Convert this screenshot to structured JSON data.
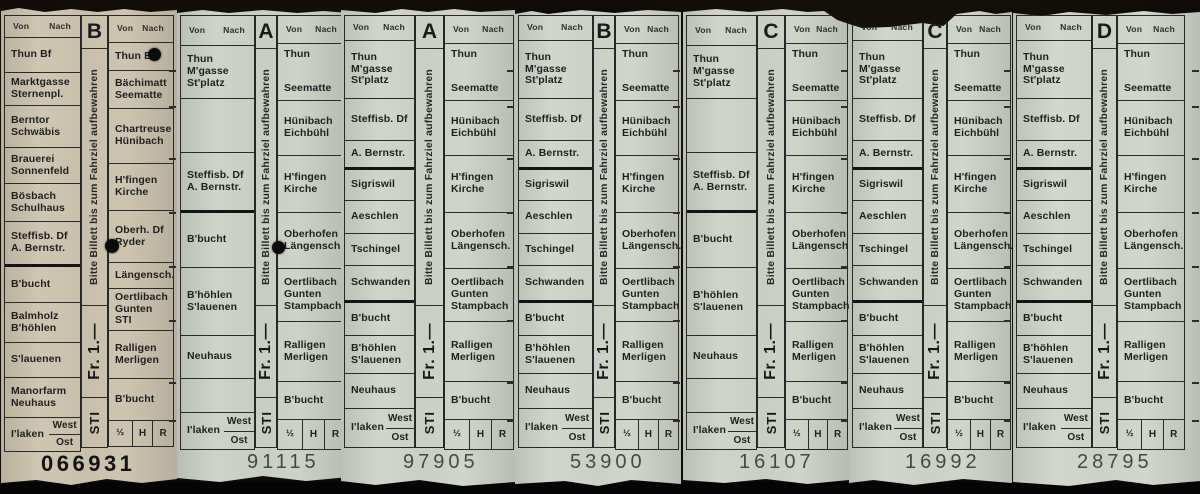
{
  "photo": {
    "background_color": "#0d0a07",
    "description_colors": {
      "beige_ticket": "#cbc3ae",
      "green_ticket": "#ced3c8",
      "print": "#1f1f1f"
    }
  },
  "shared": {
    "keep_notice": "Bitte Billett bis zum Fahrziel aufbewahren",
    "price": "Fr. 1.—",
    "operator": "STI",
    "header": {
      "von": "Von",
      "nach": "Nach"
    },
    "fare_cells": [
      "½",
      "H",
      "R"
    ],
    "ilaken": {
      "name": "I'laken",
      "top": "West",
      "bottom": "Ost"
    }
  },
  "columns": {
    "t1_left": [
      {
        "type": "header",
        "h": 22
      },
      {
        "label": "Thun Bf",
        "h": 35
      },
      {
        "label": "Marktgasse\nSternenpl.",
        "h": 33
      },
      {
        "label": "Berntor\nSchwäbis",
        "h": 42
      },
      {
        "label": "Brauerei\nSonnenfeld",
        "h": 36
      },
      {
        "label": "Bösbach\nSchulhaus",
        "h": 38
      },
      {
        "label": "Steffisb. Df\nA. Bernstr.",
        "h": 45,
        "thick": true
      },
      {
        "label": "B'bucht",
        "h": 36
      },
      {
        "label": "Balmholz\nB'höhlen",
        "h": 40
      },
      {
        "label": "S'lauenen",
        "h": 35
      },
      {
        "label": "Manorfarm\nNeuhaus",
        "h": 40
      },
      {
        "type": "ilaken",
        "h": 33
      }
    ],
    "t1_right": [
      {
        "type": "header",
        "h": 27
      },
      {
        "label": "Thun Bf",
        "h": 28
      },
      {
        "label": "Bächimatt\nSeematte",
        "h": 38
      },
      {
        "label": "Chartreuse\nHünibach",
        "h": 55
      },
      {
        "label": "H'fingen\nKirche",
        "h": 47
      },
      {
        "label": "Oberh. Df\nRyder",
        "h": 52
      },
      {
        "label": "Längensch.",
        "h": 26
      },
      {
        "label": "Oertlibach\nGunten STI",
        "h": 42
      },
      {
        "label": "Ralligen\nMerligen",
        "h": 48
      },
      {
        "label": "B'bucht",
        "h": 42
      },
      {
        "type": "fare",
        "h": 25
      }
    ],
    "x_left": [
      {
        "type": "header",
        "h": 30
      },
      {
        "label": "Thun\nM'gasse\nSt'platz",
        "h": 53
      },
      {
        "type": "empty",
        "h": 54
      },
      {
        "label": "Steffisb. Df\nA. Bernstr.",
        "h": 60,
        "thick": true
      },
      {
        "label": "B'bucht",
        "h": 55
      },
      {
        "label": "B'höhlen\nS'lauenen",
        "h": 68
      },
      {
        "label": "Neuhaus",
        "h": 43
      },
      {
        "type": "empty",
        "h": 34
      },
      {
        "type": "ilaken",
        "h": 36
      }
    ],
    "y_left": [
      {
        "type": "header",
        "h": 25
      },
      {
        "label": "Thun\nM'gasse\nSt'platz",
        "h": 58
      },
      {
        "label": "Steffisb. Df",
        "h": 42
      },
      {
        "label": "A. Bernstr.",
        "h": 29,
        "thick": true
      },
      {
        "label": "Sigriswil",
        "h": 31
      },
      {
        "label": "Aeschlen",
        "h": 33
      },
      {
        "label": "Tschingel",
        "h": 32
      },
      {
        "label": "Schwanden",
        "h": 37,
        "thick": true
      },
      {
        "label": "B'bucht",
        "h": 33
      },
      {
        "label": "B'höhlen\nS'lauenen",
        "h": 38
      },
      {
        "label": "Neuhaus",
        "h": 35
      },
      {
        "type": "ilaken",
        "h": 38
      }
    ],
    "std_right": [
      {
        "type": "header",
        "h": 28
      },
      {
        "type": "split",
        "top": "Thun",
        "bottom": "Seematte",
        "h": 57
      },
      {
        "label": "Hünibach\nEichbühl",
        "h": 55
      },
      {
        "label": "H'fingen\nKirche",
        "h": 57
      },
      {
        "label": "Oberhofen\nLängensch.",
        "h": 56
      },
      {
        "label": "Oertlibach\nGunten\nStampbach",
        "h": 53
      },
      {
        "label": "Ralligen\nMerligen",
        "h": 60
      },
      {
        "label": "B'bucht",
        "h": 38
      },
      {
        "type": "fare",
        "h": 29
      }
    ]
  },
  "tickets": [
    {
      "letter": "B",
      "serial": "066931",
      "serial_style": "dark",
      "paper": "#cbc3ae",
      "x": 1,
      "width": 176,
      "lw": 77,
      "sw": 27,
      "rw": 66,
      "serial_left": 40,
      "left": "t1_left",
      "right": "t1_right",
      "punches": [
        {
          "x": 153,
          "y": 54,
          "d": 13
        },
        {
          "x": 111,
          "y": 246,
          "d": 14
        }
      ]
    },
    {
      "letter": "A",
      "serial": "91115",
      "serial_style": "",
      "paper": "#cbd1c5",
      "x": 177,
      "width": 172,
      "lw": 75,
      "sw": 22,
      "rw": 70,
      "serial_left": 70,
      "left": "x_left",
      "right": "std_right",
      "punches": [
        {
          "x": 101,
          "y": 247,
          "d": 13
        }
      ]
    },
    {
      "letter": "A",
      "serial": "97905",
      "serial_style": "",
      "paper": "#ced3c8",
      "x": 341,
      "width": 174,
      "lw": 71,
      "sw": 29,
      "rw": 70,
      "serial_left": 62,
      "left": "y_left",
      "right": "std_right",
      "punches": []
    },
    {
      "letter": "B",
      "serial": "53900",
      "serial_style": "",
      "paper": "#cfd4ca",
      "x": 515,
      "width": 166,
      "lw": 75,
      "sw": 22,
      "rw": 64,
      "serial_left": 55,
      "left": "y_left",
      "right": "std_right",
      "punches": []
    },
    {
      "letter": "C",
      "serial": "16107",
      "serial_style": "",
      "paper": "#cdd2c7",
      "x": 683,
      "width": 166,
      "lw": 71,
      "sw": 28,
      "rw": 63,
      "serial_left": 56,
      "left": "x_left",
      "right": "std_right",
      "punches": []
    },
    {
      "letter": "C",
      "serial": "16992",
      "serial_style": "",
      "paper": "#ced4c9",
      "x": 849,
      "width": 163,
      "lw": 71,
      "sw": 24,
      "rw": 64,
      "serial_left": 56,
      "left": "y_left",
      "right": "std_right",
      "punches": []
    },
    {
      "letter": "D",
      "serial": "28795",
      "serial_style": "",
      "paper": "#d0d5ca",
      "x": 1013,
      "width": 187,
      "lw": 76,
      "sw": 25,
      "rw": 68,
      "serial_left": 64,
      "left": "y_left",
      "right": "std_right",
      "punches": []
    }
  ]
}
